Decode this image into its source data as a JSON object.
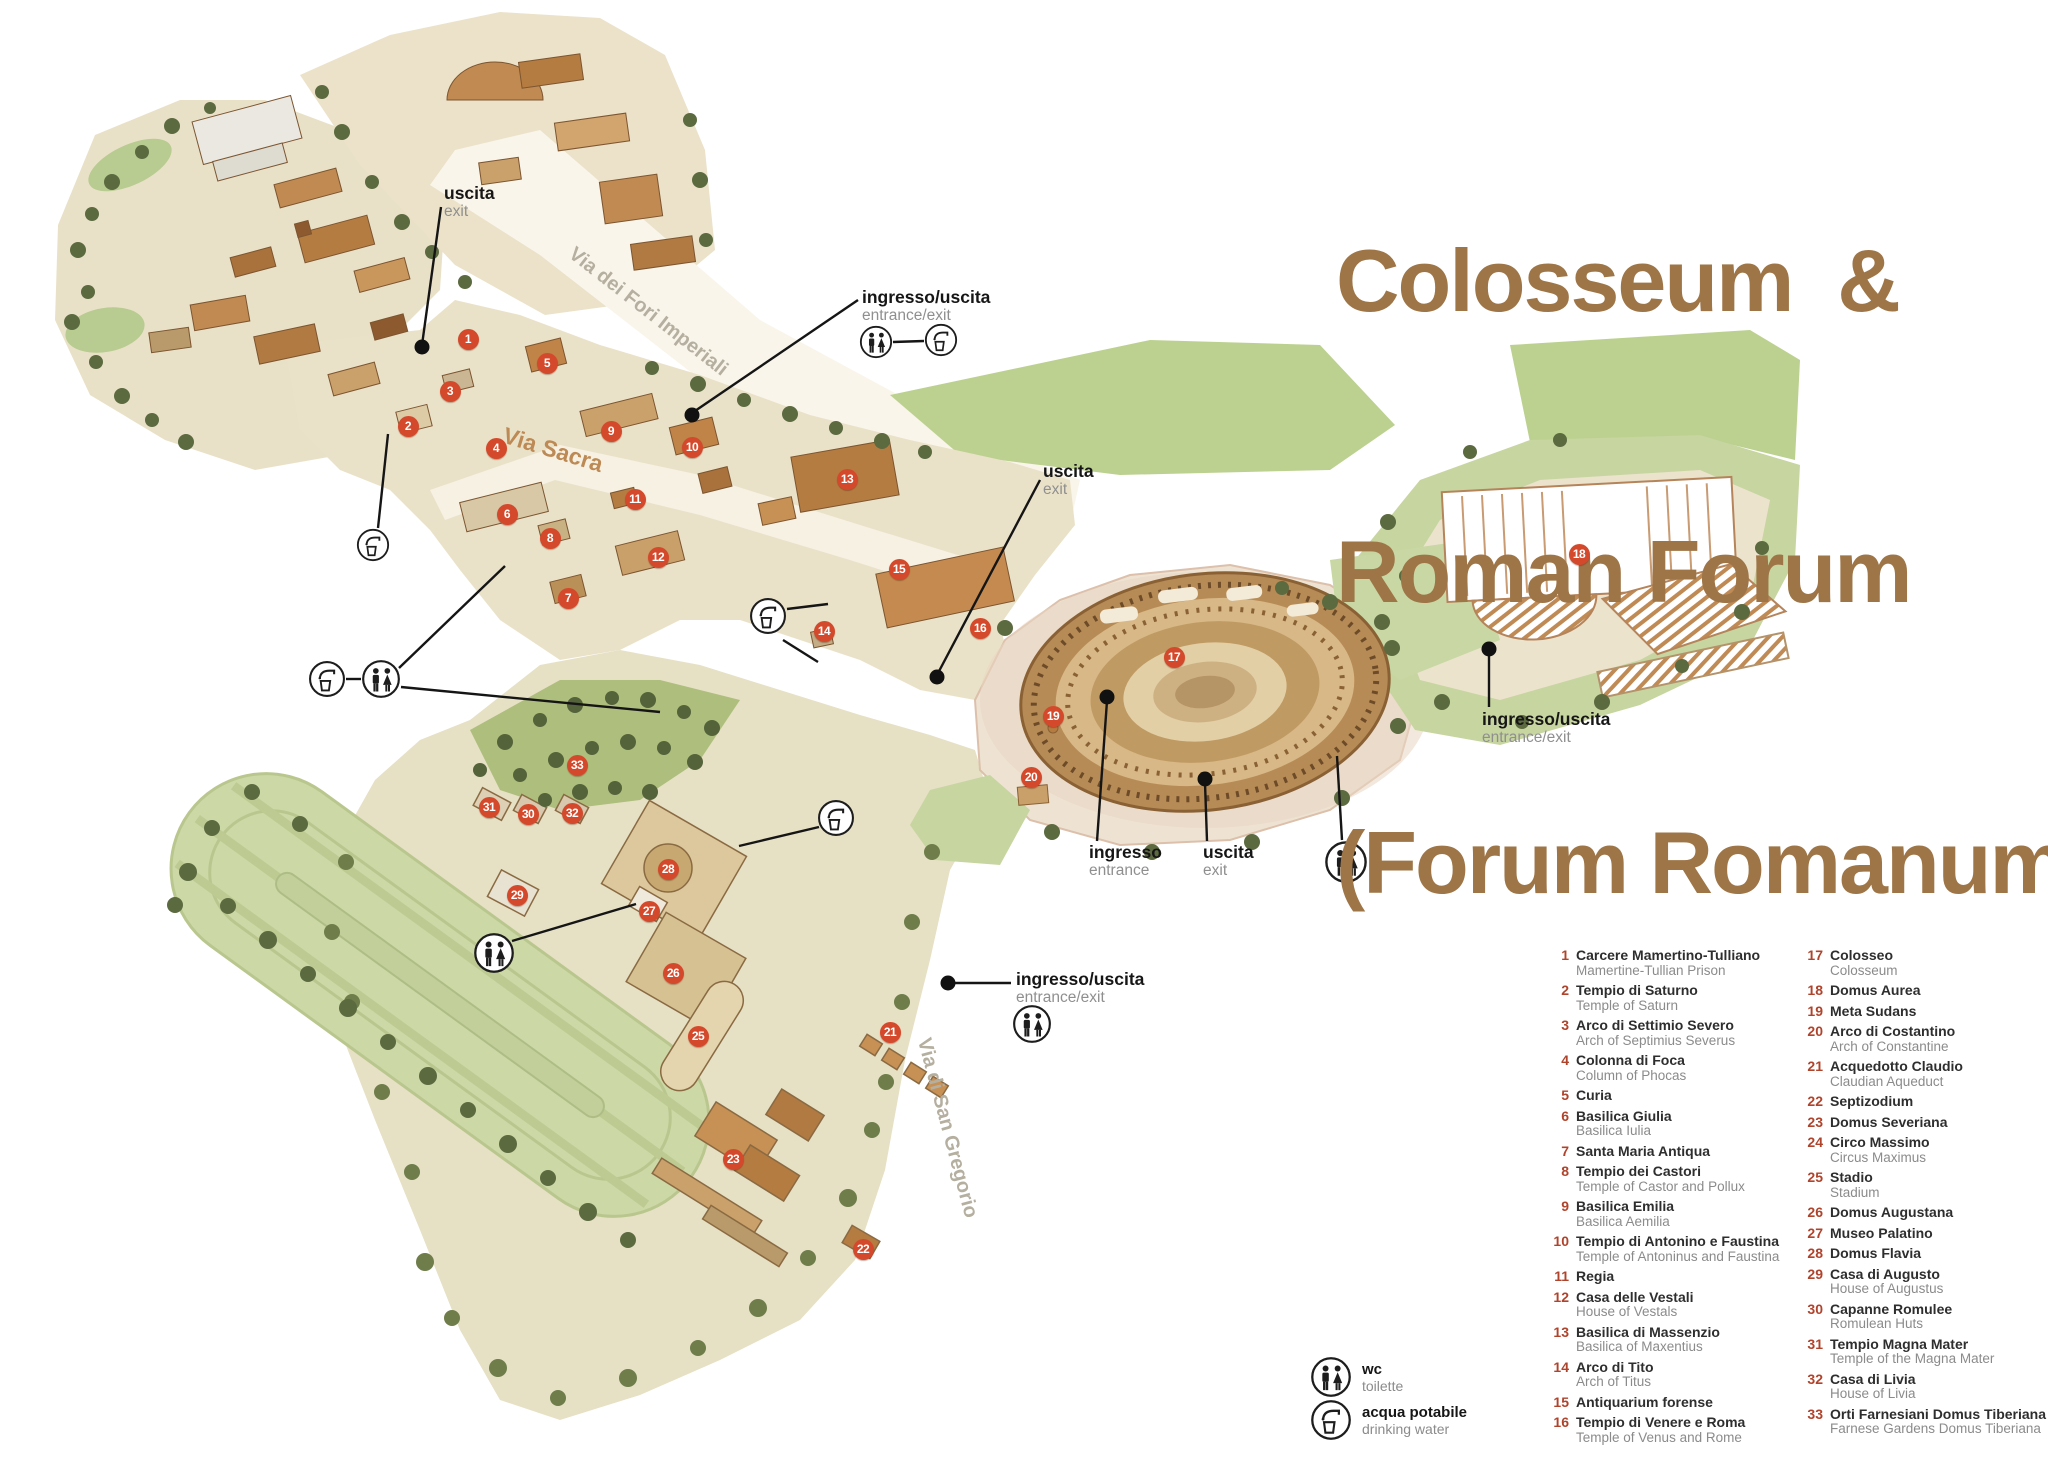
{
  "title": {
    "line1": "Colosseum  &",
    "line2": "Roman Forum",
    "line3": "(Forum Romanum)",
    "color": "#9e7547"
  },
  "legend": {
    "column1": [
      {
        "num": "1",
        "name": "Carcere Mamertino-Tulliano",
        "sub": "Mamertine-Tullian Prison"
      },
      {
        "num": "2",
        "name": "Tempio di Saturno",
        "sub": "Temple of Saturn"
      },
      {
        "num": "3",
        "name": "Arco di Settimio Severo",
        "sub": "Arch of Septimius Severus"
      },
      {
        "num": "4",
        "name": "Colonna di Foca",
        "sub": "Column of Phocas"
      },
      {
        "num": "5",
        "name": "Curia",
        "sub": ""
      },
      {
        "num": "6",
        "name": "Basilica Giulia",
        "sub": "Basilica Iulia"
      },
      {
        "num": "7",
        "name": "Santa Maria Antiqua",
        "sub": ""
      },
      {
        "num": "8",
        "name": "Tempio dei Castori",
        "sub": "Temple of Castor and Pollux"
      },
      {
        "num": "9",
        "name": "Basilica Emilia",
        "sub": "Basilica Aemilia"
      },
      {
        "num": "10",
        "name": "Tempio di Antonino e Faustina",
        "sub": "Temple of Antoninus and Faustina"
      },
      {
        "num": "11",
        "name": "Regia",
        "sub": ""
      },
      {
        "num": "12",
        "name": "Casa delle Vestali",
        "sub": "House of Vestals"
      },
      {
        "num": "13",
        "name": "Basilica di Massenzio",
        "sub": "Basilica of Maxentius"
      },
      {
        "num": "14",
        "name": "Arco di Tito",
        "sub": "Arch of Titus"
      },
      {
        "num": "15",
        "name": "Antiquarium forense",
        "sub": ""
      },
      {
        "num": "16",
        "name": "Tempio di Venere e Roma",
        "sub": "Temple of Venus and Rome"
      }
    ],
    "column2": [
      {
        "num": "17",
        "name": "Colosseo",
        "sub": "Colosseum"
      },
      {
        "num": "18",
        "name": "Domus Aurea",
        "sub": ""
      },
      {
        "num": "19",
        "name": "Meta Sudans",
        "sub": ""
      },
      {
        "num": "20",
        "name": "Arco di Costantino",
        "sub": "Arch of Constantine"
      },
      {
        "num": "21",
        "name": "Acquedotto Claudio",
        "sub": "Claudian Aqueduct"
      },
      {
        "num": "22",
        "name": "Septizodium",
        "sub": ""
      },
      {
        "num": "23",
        "name": "Domus Severiana",
        "sub": ""
      },
      {
        "num": "24",
        "name": "Circo Massimo",
        "sub": "Circus Maximus"
      },
      {
        "num": "25",
        "name": "Stadio",
        "sub": "Stadium"
      },
      {
        "num": "26",
        "name": "Domus Augustana",
        "sub": ""
      },
      {
        "num": "27",
        "name": "Museo Palatino",
        "sub": ""
      },
      {
        "num": "28",
        "name": "Domus Flavia",
        "sub": ""
      },
      {
        "num": "29",
        "name": "Casa di Augusto",
        "sub": "House of Augustus"
      },
      {
        "num": "30",
        "name": "Capanne Romulee",
        "sub": "Romulean Huts"
      },
      {
        "num": "31",
        "name": "Tempio Magna Mater",
        "sub": "Temple of the Magna Mater"
      },
      {
        "num": "32",
        "name": "Casa di Livia",
        "sub": "House of Livia"
      },
      {
        "num": "33",
        "name": "Orti Farnesiani Domus Tiberiana",
        "sub": "Farnese Gardens Domus Tiberiana"
      }
    ]
  },
  "symbols": [
    {
      "icon": "wc-icon",
      "label": "wc",
      "sub": "toilette",
      "x": 1310,
      "y": 1356
    },
    {
      "icon": "water-icon",
      "label": "acqua potabile",
      "sub": "drinking water",
      "x": 1310,
      "y": 1399
    }
  ],
  "roads": [
    {
      "name": "Via dei Fori Imperiali",
      "x": 648,
      "y": 312,
      "rot": 38,
      "color": "#b5afa0",
      "size": 20
    },
    {
      "name": "Via Sacra",
      "x": 553,
      "y": 450,
      "rot": 17,
      "color": "#bd8a55",
      "size": 23
    },
    {
      "name": "Via di San Gregorio",
      "x": 947,
      "y": 1128,
      "rot": 75,
      "color": "#b5afa0",
      "size": 20
    }
  ],
  "markers": [
    {
      "n": "1",
      "x": 468,
      "y": 339
    },
    {
      "n": "2",
      "x": 408,
      "y": 426
    },
    {
      "n": "3",
      "x": 450,
      "y": 391
    },
    {
      "n": "4",
      "x": 496,
      "y": 448
    },
    {
      "n": "5",
      "x": 547,
      "y": 363
    },
    {
      "n": "6",
      "x": 507,
      "y": 514
    },
    {
      "n": "7",
      "x": 568,
      "y": 598
    },
    {
      "n": "8",
      "x": 550,
      "y": 538
    },
    {
      "n": "9",
      "x": 611,
      "y": 431
    },
    {
      "n": "10",
      "x": 692,
      "y": 447
    },
    {
      "n": "11",
      "x": 635,
      "y": 499
    },
    {
      "n": "12",
      "x": 658,
      "y": 557
    },
    {
      "n": "13",
      "x": 847,
      "y": 479
    },
    {
      "n": "14",
      "x": 824,
      "y": 631
    },
    {
      "n": "15",
      "x": 899,
      "y": 569
    },
    {
      "n": "16",
      "x": 980,
      "y": 628
    },
    {
      "n": "17",
      "x": 1174,
      "y": 657
    },
    {
      "n": "18",
      "x": 1579,
      "y": 554
    },
    {
      "n": "19",
      "x": 1053,
      "y": 716
    },
    {
      "n": "20",
      "x": 1031,
      "y": 777
    },
    {
      "n": "21",
      "x": 890,
      "y": 1032
    },
    {
      "n": "22",
      "x": 863,
      "y": 1249
    },
    {
      "n": "23",
      "x": 733,
      "y": 1159
    },
    {
      "n": "25",
      "x": 698,
      "y": 1036
    },
    {
      "n": "26",
      "x": 673,
      "y": 973
    },
    {
      "n": "27",
      "x": 649,
      "y": 911
    },
    {
      "n": "28",
      "x": 668,
      "y": 869
    },
    {
      "n": "29",
      "x": 517,
      "y": 895
    },
    {
      "n": "30",
      "x": 528,
      "y": 814
    },
    {
      "n": "31",
      "x": 489,
      "y": 807
    },
    {
      "n": "32",
      "x": 572,
      "y": 813
    },
    {
      "n": "33",
      "x": 577,
      "y": 765
    }
  ],
  "annotations": [
    {
      "id": "exit-northwest",
      "label": "uscita",
      "sub": "exit",
      "lx": 444,
      "ly": 184,
      "lines": [
        [
          441,
          207,
          422,
          345
        ]
      ],
      "dots": [
        [
          422,
          347
        ]
      ],
      "icons": []
    },
    {
      "id": "entrance-north",
      "label": "ingresso/uscita",
      "sub": "entrance/exit",
      "lx": 862,
      "ly": 288,
      "lines": [
        [
          858,
          300,
          692,
          413
        ],
        [
          893,
          342,
          924,
          341
        ]
      ],
      "dots": [
        [
          692,
          415
        ]
      ],
      "icons": [
        {
          "t": "wc",
          "x": 876,
          "y": 342,
          "r": 17
        },
        {
          "t": "water",
          "x": 941,
          "y": 340,
          "r": 17
        }
      ]
    },
    {
      "id": "exit-northeast",
      "label": "uscita",
      "sub": "exit",
      "lx": 1043,
      "ly": 462,
      "lines": [
        [
          1040,
          480,
          937,
          675
        ]
      ],
      "dots": [
        [
          937,
          677
        ]
      ],
      "icons": []
    },
    {
      "id": "colosseum-entrance",
      "label": "ingresso",
      "sub": "entrance",
      "lx": 1089,
      "ly": 843,
      "lines": [
        [
          1097,
          841,
          1107,
          701
        ]
      ],
      "dots": [
        [
          1107,
          697
        ]
      ],
      "icons": []
    },
    {
      "id": "colosseum-exit",
      "label": "uscita",
      "sub": "exit",
      "lx": 1203,
      "ly": 843,
      "lines": [
        [
          1207,
          841,
          1205,
          783
        ]
      ],
      "dots": [
        [
          1205,
          779
        ]
      ],
      "icons": []
    },
    {
      "id": "entrance-east",
      "label": "ingresso/uscita",
      "sub": "entrance/exit",
      "lx": 1482,
      "ly": 710,
      "lines": [
        [
          1489,
          707,
          1489,
          655
        ]
      ],
      "dots": [
        [
          1489,
          649
        ]
      ],
      "icons": []
    },
    {
      "id": "entrance-south",
      "label": "ingresso/uscita",
      "sub": "entrance/exit",
      "lx": 1016,
      "ly": 970,
      "lines": [
        [
          955,
          983,
          1011,
          983
        ]
      ],
      "dots": [
        [
          948,
          983
        ]
      ],
      "icons": [
        {
          "t": "wc",
          "x": 1032,
          "y": 1024,
          "r": 20
        }
      ]
    }
  ],
  "map_icons": [
    {
      "t": "water",
      "x": 373,
      "y": 545,
      "r": 17,
      "lines": [
        [
          378,
          528,
          388,
          434
        ]
      ]
    },
    {
      "t": "water",
      "x": 327,
      "y": 679,
      "r": 19,
      "lines": [
        [
          346,
          679,
          361,
          679
        ]
      ]
    },
    {
      "t": "wc",
      "x": 381,
      "y": 679,
      "r": 20,
      "lines": [
        [
          399,
          668,
          505,
          566
        ],
        [
          401,
          687,
          660,
          712
        ]
      ]
    },
    {
      "t": "water",
      "x": 768,
      "y": 616,
      "r": 19,
      "lines": [
        [
          787,
          609,
          828,
          604
        ],
        [
          783,
          640,
          818,
          662
        ]
      ]
    },
    {
      "t": "wc",
      "x": 494,
      "y": 953,
      "r": 21,
      "lines": [
        [
          512,
          941,
          636,
          904
        ]
      ]
    },
    {
      "t": "water",
      "x": 836,
      "y": 818,
      "r": 19,
      "lines": [
        [
          819,
          827,
          739,
          846
        ]
      ]
    },
    {
      "t": "wc",
      "x": 1346,
      "y": 862,
      "r": 22,
      "lines": [
        [
          1342,
          840,
          1337,
          756
        ]
      ]
    }
  ]
}
